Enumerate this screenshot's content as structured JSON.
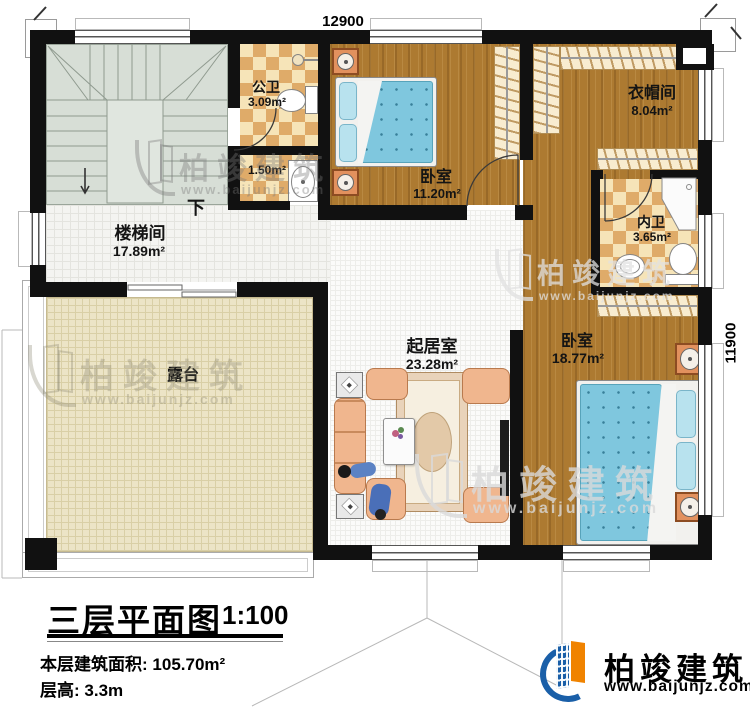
{
  "dimensions": {
    "top": "12900",
    "right": "11900"
  },
  "rooms": {
    "public_bath": {
      "name": "公卫",
      "area": "3.09m²"
    },
    "small_bath": {
      "area": "1.50m²"
    },
    "bedroom1": {
      "name": "卧室",
      "area": "11.20m²"
    },
    "cloakroom": {
      "name": "衣帽间",
      "area": "8.04m²"
    },
    "ensuite_bath": {
      "name": "内卫",
      "area": "3.65m²"
    },
    "stairwell": {
      "name": "楼梯间",
      "area": "17.89m²"
    },
    "living_room": {
      "name": "起居室",
      "area": "23.28m²"
    },
    "bedroom2": {
      "name": "卧室",
      "area": "18.77m²"
    },
    "terrace": {
      "name": "露台"
    }
  },
  "stairs": {
    "down_label": "下"
  },
  "title_block": {
    "title": "三层平面图",
    "scale": "1:100",
    "floor_area_label": "本层建筑面积:",
    "floor_area_value": "105.70m²",
    "floor_height_label": "层高:",
    "floor_height_value": "3.3m"
  },
  "brand": {
    "name": "柏竣建筑",
    "website": "www.baijunjz.com"
  },
  "watermark": {
    "name": "柏竣建筑",
    "website": "www.baijunjz.com"
  },
  "colors": {
    "wall": "#111111",
    "wood": "#ad7a31",
    "checker_light": "#f6e4b8",
    "checker_dark": "#dfab69",
    "terrace_floor": "#ece4c6",
    "stair_floor": "#d7ded6",
    "bed_blue": "#7fc7de",
    "logo_blue": "#1a5fa8",
    "logo_orange": "#f08300"
  }
}
